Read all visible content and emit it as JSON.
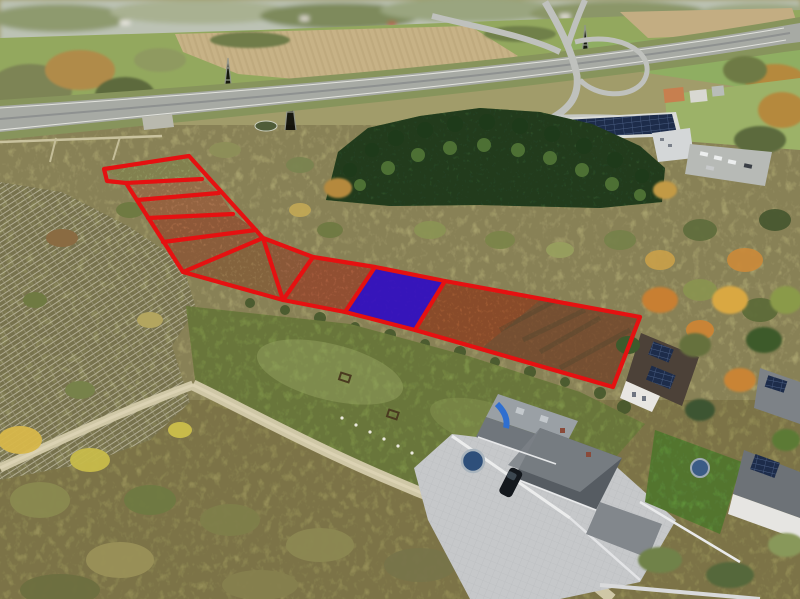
{
  "image": {
    "kind": "aerial-drone-photo",
    "description": "Autumn aerial view of land parcels for sale: red-outlined plots with one plot highlighted blue, highway interchange at top, conifer tree row and solar-roof warehouse mid-right, white lattice frames on left, mowed lawn and houses at bottom right",
    "width": 800,
    "height": 599
  },
  "palette": {
    "plot_outline_red": "#e51111",
    "highlight_blue": "#2209e0",
    "plot_soil": "#a85a33",
    "lawn_green": "#7d9148",
    "scrub_olive": "#a19c6a",
    "forest_dark_green": "#31502a",
    "highway_gray": "#a7aaa4",
    "dirt_road_tan": "#cfc7a6"
  },
  "overlay": {
    "stroke_color": "#e51111",
    "stroke_width": 4.2,
    "boundary_points": "104,169 189,156 263,238 313,257 375,267 445,281 640,317 613,387 415,330 345,312 283,300 183,272 126,183 107,181",
    "divider_lines": [
      "126,183 202,179",
      "137,200 219,193",
      "148,218 233,214",
      "163,242 256,230",
      "183,272 263,238",
      "263,238 283,300",
      "313,257 283,300",
      "375,267 345,312",
      "445,281 415,330"
    ],
    "highlighted_plot": {
      "points": "375,267 445,281 415,330 345,312",
      "fill": "#2209e0",
      "opacity": 0.8
    }
  }
}
